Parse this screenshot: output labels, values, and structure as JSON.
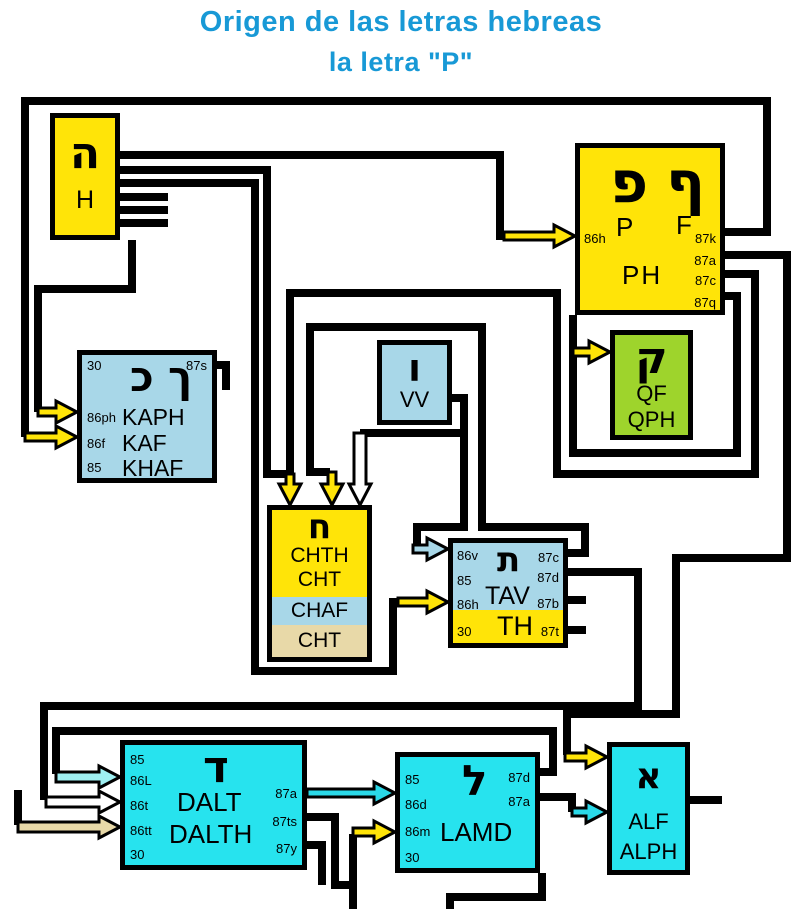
{
  "title": {
    "line1": "Origen de las letras hebreas",
    "line2": "la letra \"P\""
  },
  "colors": {
    "title_blue": "#1899d6",
    "yellow": "#ffe408",
    "light_blue": "#a8d7e8",
    "green": "#9ed42c",
    "cyan": "#27e3ee",
    "tan": "#e8d9a8",
    "arrow_pale_cyan": "#9ff0f2",
    "arrow_cyan": "#2ad9e8",
    "arrow_white": "#ffffff"
  },
  "boxes": {
    "h": {
      "hebrew": "ה",
      "label": "H"
    },
    "ph": {
      "hebrew_left": "פ",
      "hebrew_right": "ף",
      "p": "P",
      "f": "F",
      "main": "PH",
      "in1": "86h",
      "out1": "87k",
      "out2": "87a",
      "out3": "87c",
      "out4": "87q"
    },
    "kaph": {
      "hebrew_left": "כ",
      "hebrew_right": "ך",
      "tl": "30",
      "tr": "87s",
      "p1": "86ph",
      "w1": "KAPH",
      "p2": "86f",
      "w2": "KAF",
      "p3": "85",
      "w3": "KHAF"
    },
    "vv": {
      "hebrew": "ו",
      "label": "VV"
    },
    "qf": {
      "hebrew": "ק",
      "l1": "QF",
      "l2": "QPH"
    },
    "chth": {
      "hebrew": "ח",
      "y1": "CHTH",
      "y2": "CHT",
      "blue": "CHAF",
      "tan": "CHT"
    },
    "tav": {
      "hebrew": "ת",
      "label": "TAV",
      "th": "TH",
      "in1": "86v",
      "in2": "85",
      "in3": "86h",
      "in4": "30",
      "out1": "87c",
      "out2": "87d",
      "out3": "87b",
      "out4": "87t"
    },
    "dalt": {
      "hebrew": "ד",
      "l1": "DALT",
      "l2": "DALTH",
      "p1": "85",
      "p2": "86L",
      "p3": "86t",
      "p4": "86tt",
      "p5": "30",
      "o1": "87a",
      "o2": "87ts",
      "o3": "87y"
    },
    "lamd": {
      "hebrew": "ל",
      "label": "LAMD",
      "p1": "85",
      "p2": "86d",
      "p3": "86m",
      "p4": "30",
      "o1": "87d",
      "o2": "87a"
    },
    "alf": {
      "hebrew": "א",
      "l1": "ALF",
      "l2": "ALPH"
    }
  }
}
